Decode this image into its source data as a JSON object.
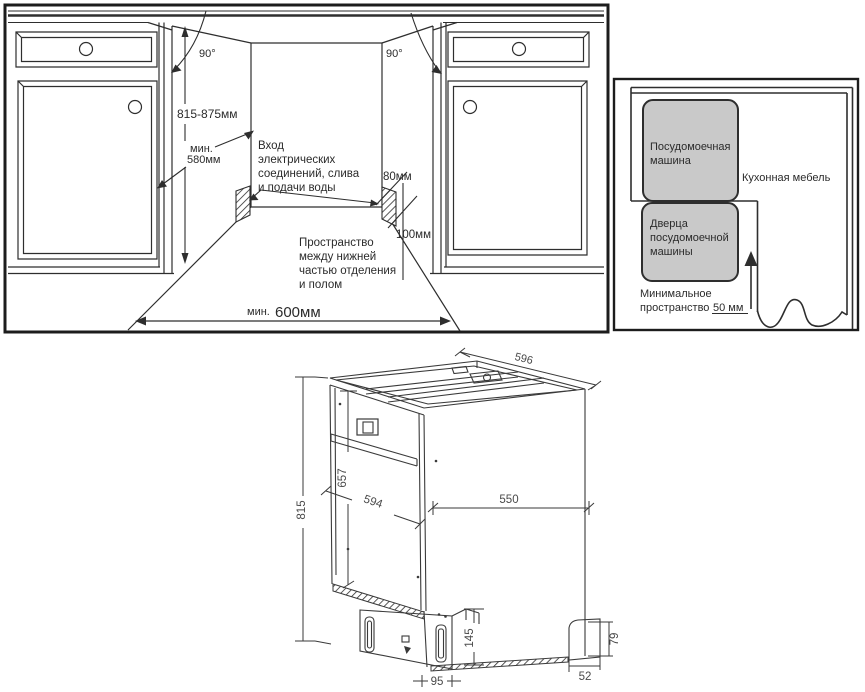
{
  "colors": {
    "line": "#2e2e2e",
    "line_3d": "#3a3a3a",
    "panel_border": "#1c1c1c",
    "gray_fill": "#c9c9c9",
    "background": "#ffffff"
  },
  "niche_panel": {
    "angle_left": "90°",
    "angle_right": "90°",
    "height_range": "815-875мм",
    "depth_min": [
      "мин.",
      "580мм"
    ],
    "inlet_note": [
      "Вход",
      "электрических",
      "соединений, слива",
      "и подачи воды"
    ],
    "dim_80": "80мм",
    "dim_100": "100мм",
    "floor_note": [
      "Пространство",
      "между нижней",
      "частью отделения",
      "и полом"
    ],
    "width_min_prefix": "мин.",
    "width_min_value": "600мм"
  },
  "top_view_panel": {
    "dishwasher": [
      "Посудомоечная",
      "машина"
    ],
    "door": [
      "Дверца",
      "посудомоечной",
      "машины"
    ],
    "furniture": "Кухонная мебель",
    "min_space": [
      "Минимальное",
      "пространство"
    ],
    "min_space_value": "50 мм"
  },
  "dimensions_3d": {
    "depth": "596",
    "height": "815",
    "door_height": "657",
    "door_width": "594",
    "side_width": "550",
    "base_height": "145",
    "base_inset": "95",
    "foot_width": "52",
    "foot_height": "79"
  }
}
